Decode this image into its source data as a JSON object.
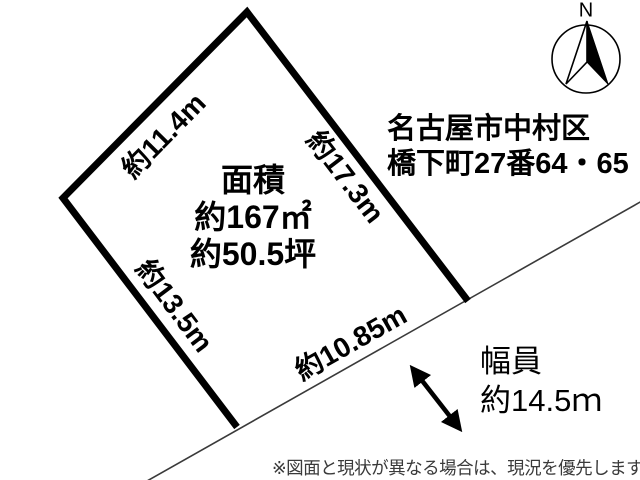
{
  "plot": {
    "area_title": "面積",
    "area_m2": "約167㎡",
    "area_tsubo": "約50.5坪",
    "edges": {
      "top_left": "約11.4m",
      "right": "約17.3m",
      "left": "約13.5m",
      "bottom": "約10.85m"
    }
  },
  "address": {
    "line1": "名古屋市中村区",
    "line2": "橋下町27番64・65"
  },
  "road": {
    "width_label": "幅員",
    "width_value": "約14.5ｍ"
  },
  "compass": {
    "north_label": "N"
  },
  "note": "※図面と現状が異なる場合は、現況を優先します。",
  "colors": {
    "outline": "#000000",
    "road_line": "#3a3a3a",
    "note_text": "#3a3a3a",
    "background": "#ffffff"
  }
}
